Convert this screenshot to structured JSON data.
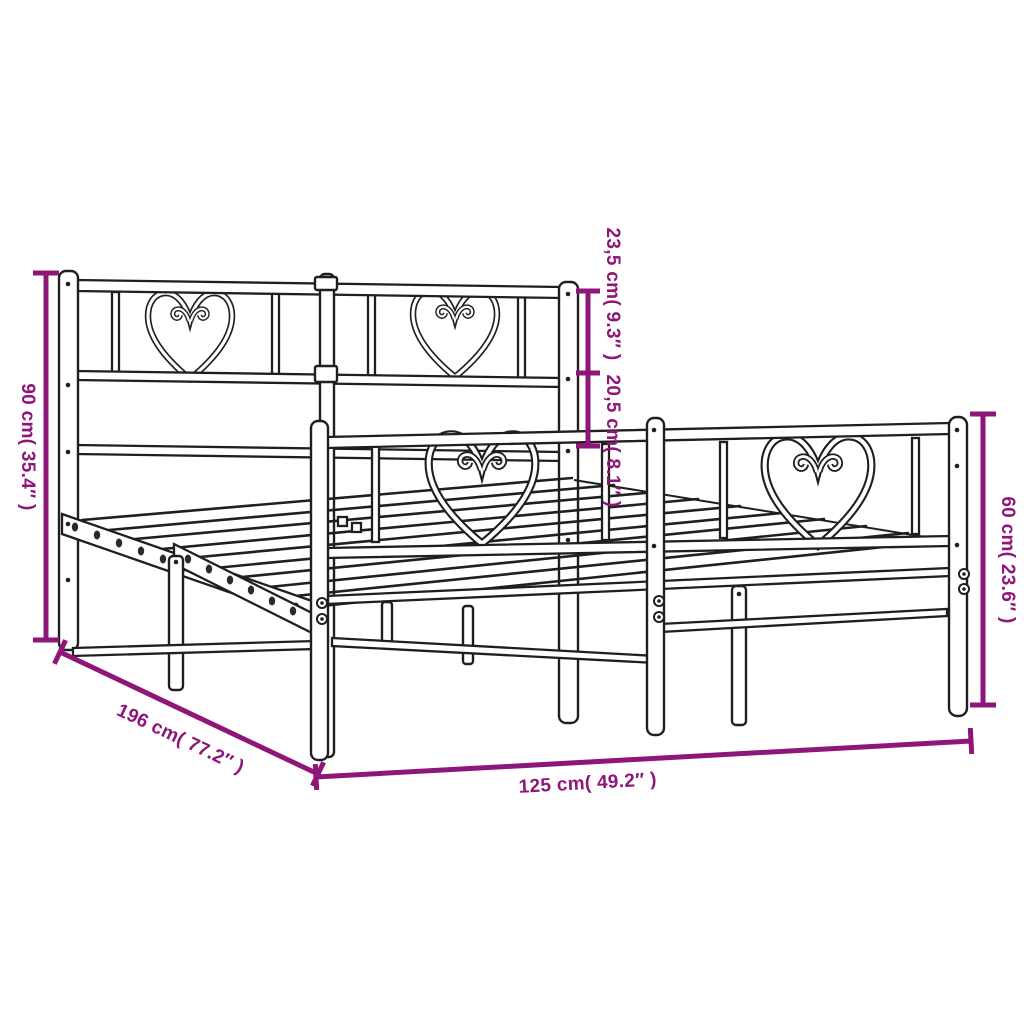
{
  "diagram": {
    "background_color": "#ffffff",
    "drawing_color": "#1f1f1f",
    "dimension_color": "#8E1679",
    "product": "metal bed frame with heart-patterned headboard and footboard",
    "dimensions": {
      "headboard_height": "90 cm( 35.4″ )",
      "headboard_top_section": "23,5 cm( 9.3″ )",
      "headboard_mid_section": "20,5 cm( 8.1″ )",
      "footboard_height": "60 cm( 23.6″ )",
      "bed_length": "196 cm( 77.2″ )",
      "bed_width": "125 cm( 49.2″ )"
    }
  }
}
